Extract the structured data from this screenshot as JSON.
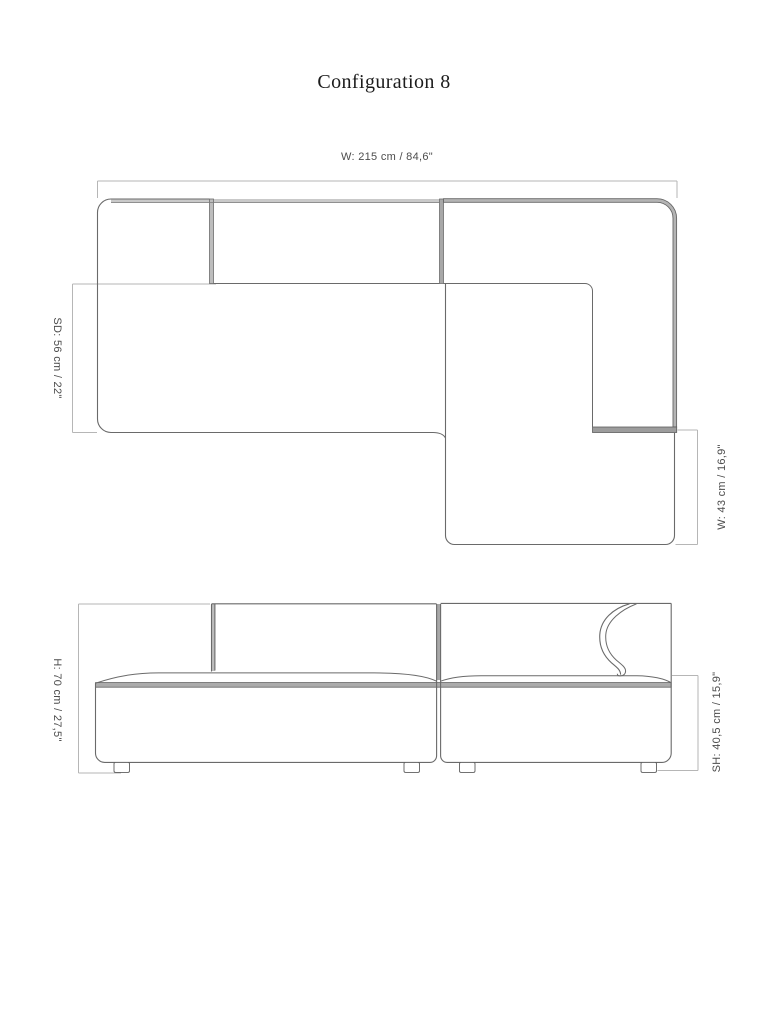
{
  "title": "Configuration 8",
  "plan_view": {
    "dim_overall_width": "W: 215 cm / 84,6\"",
    "dim_seat_depth": "SD: 56 cm / 22\"",
    "dim_chaise_width": "W: 43 cm / 16,9\""
  },
  "elevation_view": {
    "dim_height": "H: 70 cm / 27,5\"",
    "dim_seat_height": "SH: 40,5 cm / 15,9\""
  },
  "colors": {
    "background": "#ffffff",
    "outline": "#6a6a6a",
    "dimension_line": "#b6b6b6",
    "band_fill": "#b4b4b4",
    "seam_fill": "#a8a8a8",
    "label_text": "#4c4c4c",
    "title_text": "#1c1c1c"
  }
}
